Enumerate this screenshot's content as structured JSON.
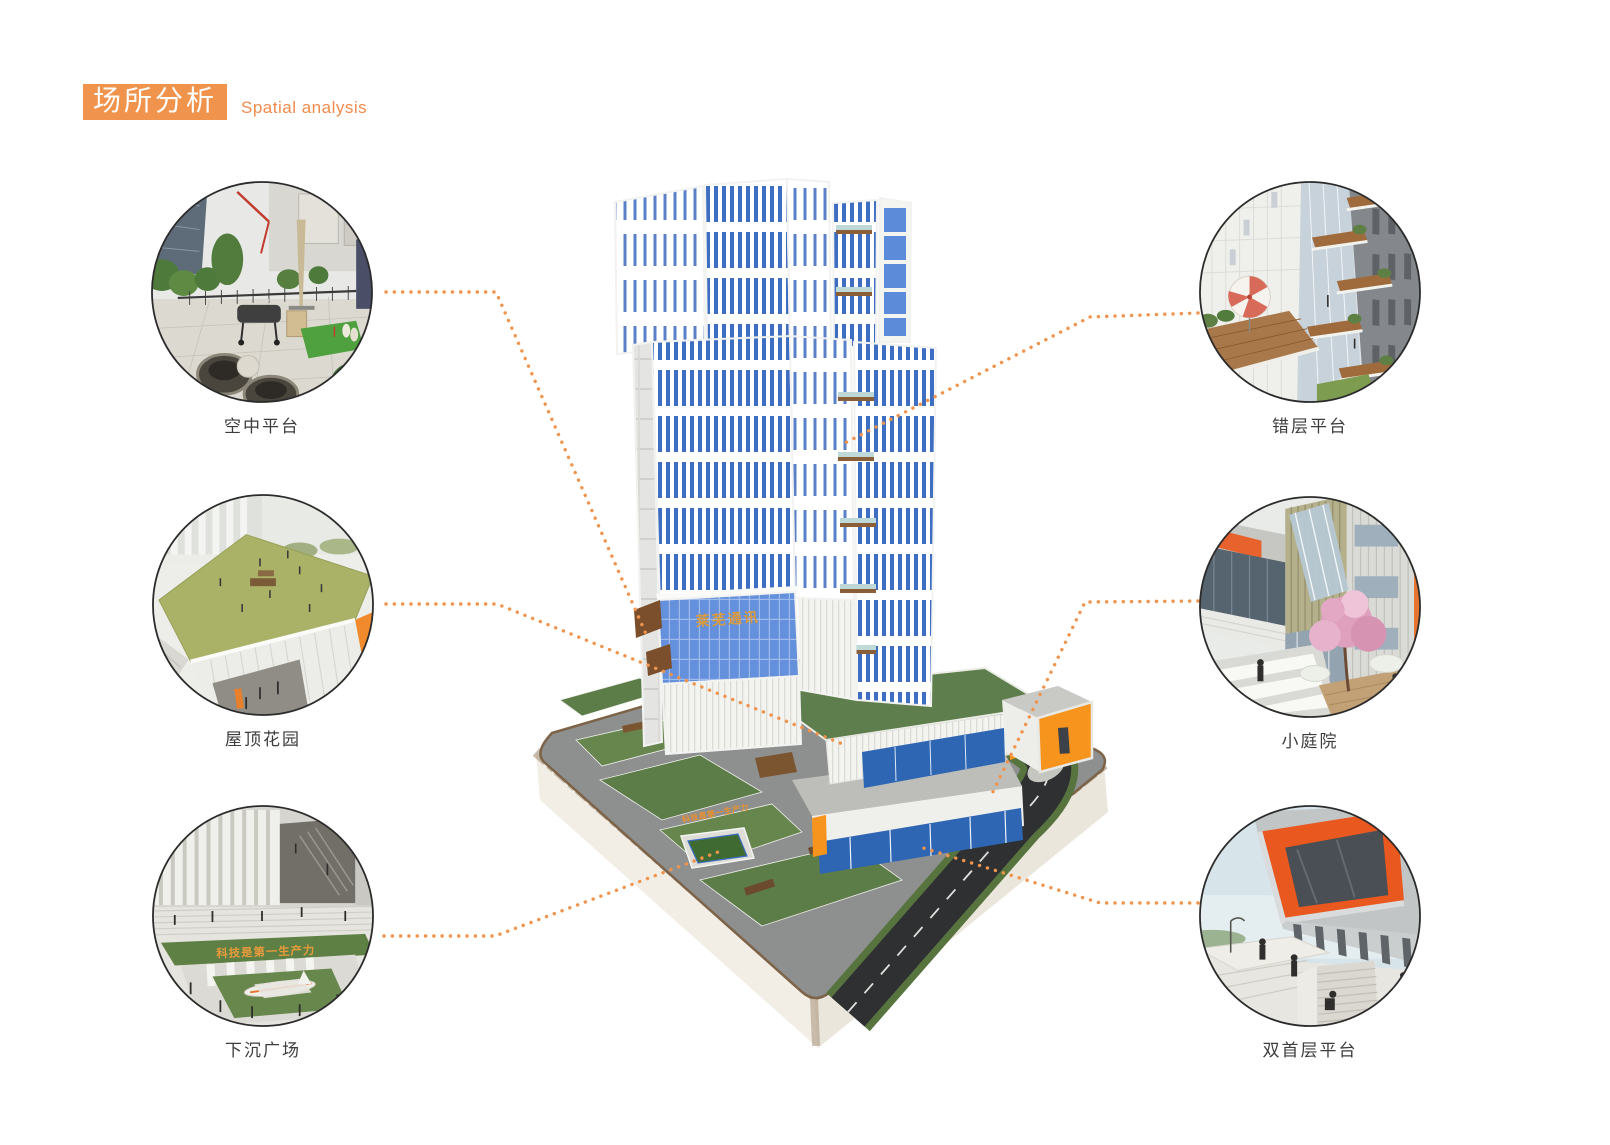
{
  "header": {
    "title_zh": "场所分析",
    "title_en": "Spatial analysis"
  },
  "building": {
    "band_text": "莱芜通讯",
    "plaza_slogan": "科技是第一生产力"
  },
  "callouts": [
    {
      "id": "sky-platform",
      "label": "空中平台"
    },
    {
      "id": "roof-garden",
      "label": "屋顶花园"
    },
    {
      "id": "sunken-plaza",
      "label": "下沉广场",
      "overlay_text": "科技是第一生产力"
    },
    {
      "id": "staggered-platform",
      "label": "错层平台"
    },
    {
      "id": "small-courtyard",
      "label": "小庭院"
    },
    {
      "id": "double-ground-floor-platform",
      "label": "双首层平台"
    }
  ],
  "colors": {
    "accent": "#F0944D",
    "tower_stripe_blue": "#3E6EC2",
    "glass_band_blue": "#6590DC",
    "orange_box": "#F7941D",
    "roof_green": "#5E7F4D",
    "plaza_gray": "#8E8F8F",
    "road_dark": "#2E3032",
    "earth_brown": "#8A6F52"
  }
}
